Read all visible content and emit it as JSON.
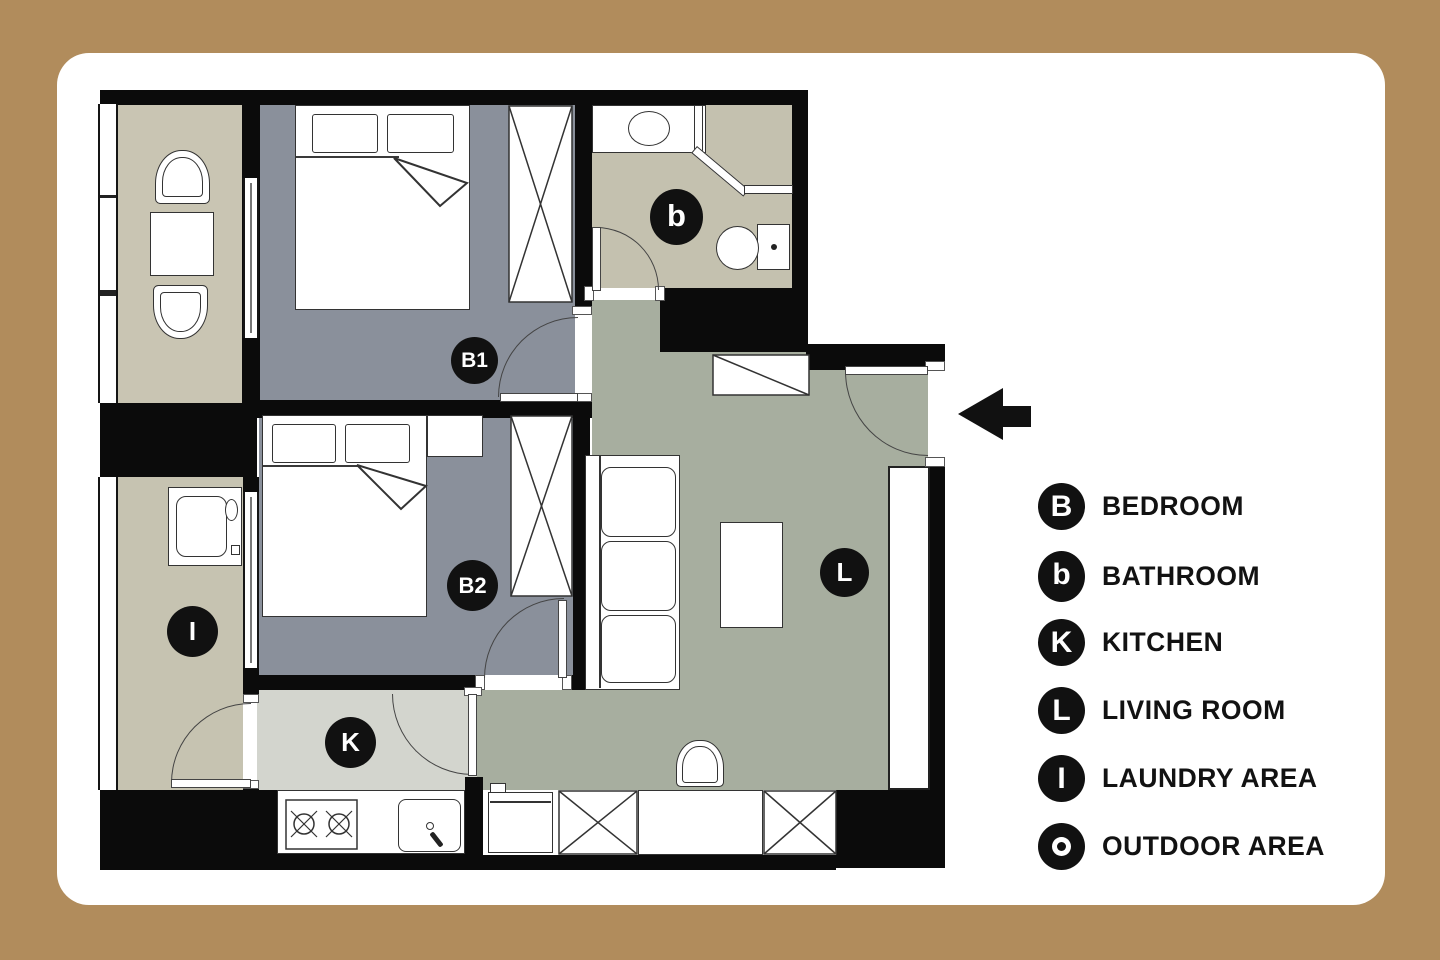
{
  "palette": {
    "page_bg": "#B18C5C",
    "card_bg": "#FFFFFF",
    "wall": "#0B0B0B",
    "bedroom_floor": "#8A909B",
    "living_floor": "#A7AE9F",
    "outdoor_floor": "#C9C5B3",
    "bathroom_floor": "#C4C1AF",
    "laundry_floor": "#C6C3B1",
    "kitchen_floor": "#D3D5CE",
    "line": "#333333",
    "label_bg": "#111111",
    "label_fg": "#FFFFFF"
  },
  "plan": {
    "room_labels": {
      "bedroom1": "B1",
      "bedroom2": "B2",
      "bathroom": "b",
      "kitchen": "K",
      "living_room": "L",
      "laundry": "I"
    }
  },
  "legend": {
    "items": [
      {
        "letter": "B",
        "label": "BEDROOM"
      },
      {
        "letter": "b",
        "label": "BATHROOM"
      },
      {
        "letter": "K",
        "label": "KITCHEN"
      },
      {
        "letter": "L",
        "label": "LIVING ROOM"
      },
      {
        "letter": "I",
        "label": "LAUNDRY AREA"
      },
      {
        "letter": "O",
        "label": "OUTDOOR AREA",
        "icon": "target"
      }
    ]
  }
}
